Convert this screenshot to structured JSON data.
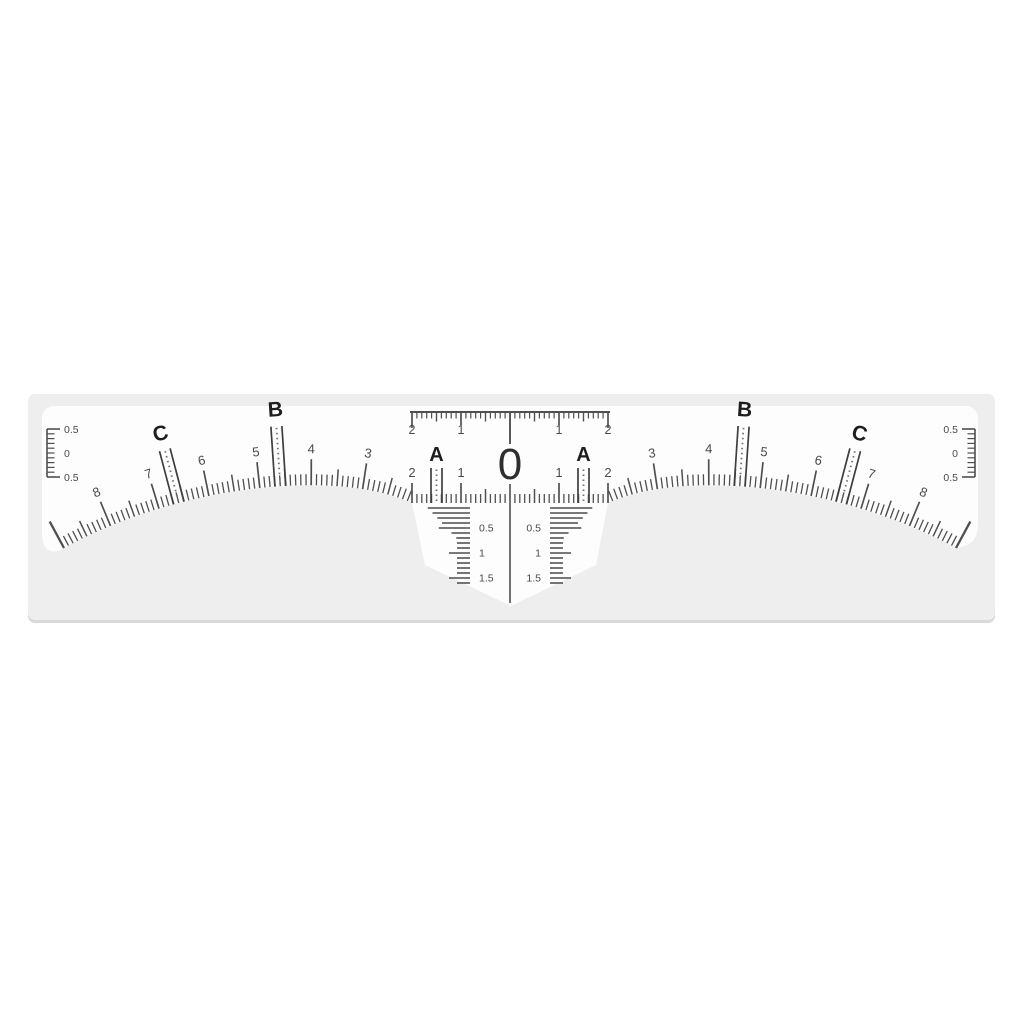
{
  "backing": {
    "color": "#eeeeef",
    "shadow_color": "#d9d9db"
  },
  "sticker": {
    "color": "#fdfdfd",
    "tick_color": "#4f4f4f",
    "marker_line_color": "#3e3e3e",
    "dotted_line_color": "#707070",
    "number_color": "#4a4a4a",
    "letter_color": "#1e1e1e",
    "zero_color": "#2e2e2e",
    "drop_tick_color": "#666666"
  },
  "center_scale": {
    "zero_label": "0",
    "top_numbers": [
      "2",
      "1",
      "1",
      "2"
    ],
    "bottom_numbers": [
      "2",
      "1",
      "1",
      "2"
    ]
  },
  "arc_scale": {
    "left_numbers": [
      "3",
      "4",
      "5",
      "6",
      "7",
      "8"
    ],
    "right_numbers": [
      "3",
      "4",
      "5",
      "6",
      "7",
      "8"
    ]
  },
  "markers": [
    {
      "label": "A",
      "position": 1.5
    },
    {
      "label": "B",
      "position": 4.6
    },
    {
      "label": "C",
      "position": 6.6
    }
  ],
  "side_scales": {
    "left_labels": [
      "0.5",
      "0",
      "0.5"
    ],
    "right_labels": [
      "0.5",
      "0",
      "0.5"
    ]
  },
  "drop_scales": {
    "left_labels": [
      "0.5",
      "1",
      "1.5"
    ],
    "right_labels": [
      "0.5",
      "1",
      "1.5"
    ]
  }
}
